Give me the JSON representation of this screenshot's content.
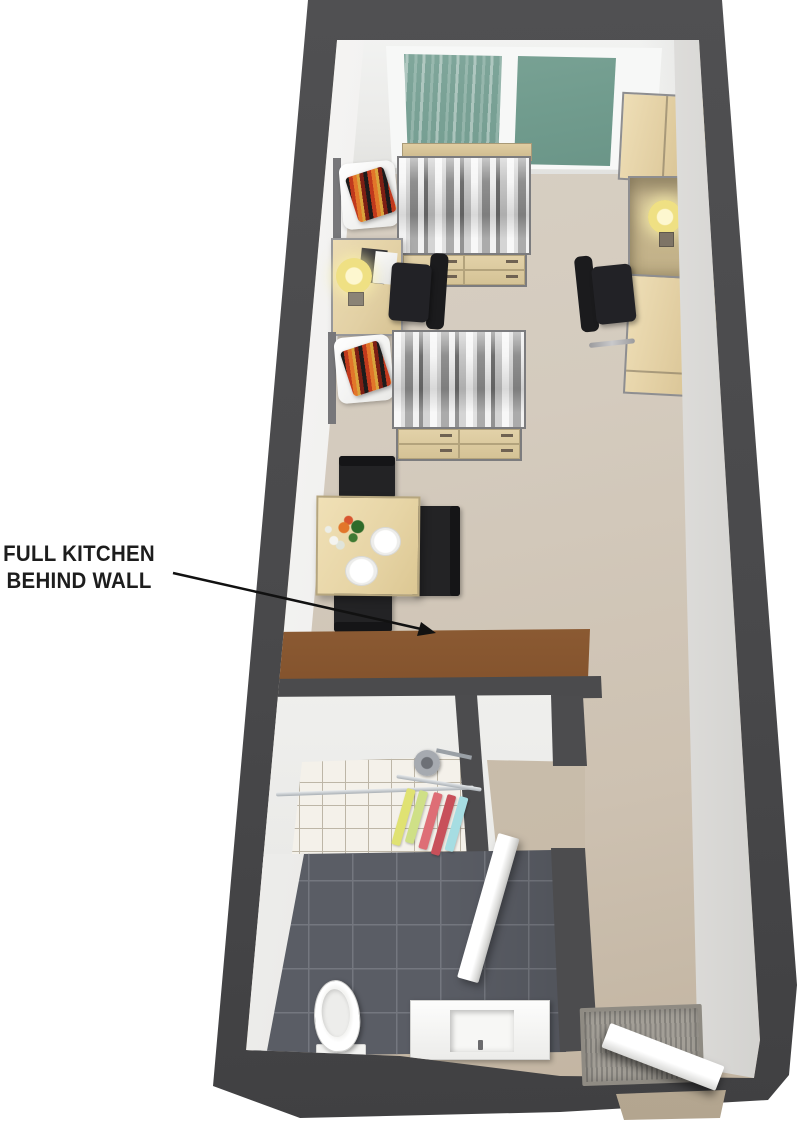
{
  "annotation": {
    "line1": "FULL KITCHEN",
    "line2": "BEHIND WALL"
  },
  "palette": {
    "wall_dark_gray": "#4b4b4d",
    "floor_beige": "#d3cabd",
    "kitchen_wall_brown": "#8a5730",
    "window_glass_green": "#79a195",
    "wood_light": "#e2d1a8",
    "bath_floor_dark": "#5a5d65",
    "bath_tile_white": "#f4f1ea",
    "chair_black": "#222226",
    "cushion_accent_red": "#c0391d",
    "lamp_yellow": "#efe083",
    "towel_yellow": "#e0e272",
    "towel_red": "#c8505a",
    "towel_cyan": "#a6dde2"
  },
  "scene": {
    "type": "3d-floorplan-render",
    "rooms": [
      {
        "name": "main-room",
        "contents": [
          "window-with-green-glass",
          "bed-1-with-striped-duvet",
          "bed-2-with-striped-duvet",
          "underbed-drawers",
          "striped-accent-cushions",
          "desk-1-with-lamp-and-laptop",
          "desk-2-with-lamp",
          "office-chair-1",
          "office-chair-2",
          "wardrobe-1",
          "wardrobe-2",
          "dining-table-with-plates-and-flowers",
          "dining-chairs-x3"
        ]
      },
      {
        "name": "kitchen",
        "contents": [
          "brown-wall-kitchen-hidden-behind"
        ]
      },
      {
        "name": "bathroom",
        "contents": [
          "shower-head",
          "shower-rod",
          "towel-rail-with-towels",
          "white-tile-wall",
          "dark-tile-floor",
          "toilet",
          "sink-vanity",
          "open-bathroom-door"
        ]
      },
      {
        "name": "entry",
        "contents": [
          "doormat",
          "open-entry-door"
        ]
      }
    ]
  }
}
